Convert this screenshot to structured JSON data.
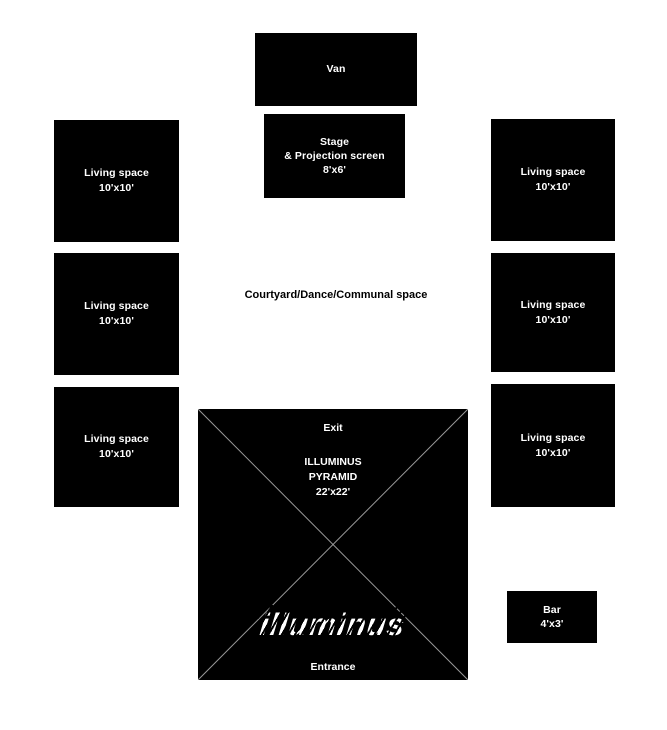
{
  "colors": {
    "background": "#ffffff",
    "box_fill": "#000000",
    "box_text": "#ffffff",
    "diagonal_line": "#9a9a9a",
    "courtyard_text": "#000000"
  },
  "van": {
    "label": "Van"
  },
  "stage": {
    "line1": "Stage",
    "line2": "& Projection screen",
    "line3": "8'x6'"
  },
  "living_spaces": [
    {
      "id": "left-1",
      "line1": "Living space",
      "line2": "10'x10'"
    },
    {
      "id": "left-2",
      "line1": "Living space",
      "line2": "10'x10'"
    },
    {
      "id": "left-3",
      "line1": "Living space",
      "line2": "10'x10'"
    },
    {
      "id": "right-1",
      "line1": "Living space",
      "line2": "10'x10'"
    },
    {
      "id": "right-2",
      "line1": "Living space",
      "line2": "10'x10'"
    },
    {
      "id": "right-3",
      "line1": "Living space",
      "line2": "10'x10'"
    }
  ],
  "courtyard": {
    "label": "Courtyard/Dance/Communal space"
  },
  "pyramid": {
    "exit_label": "Exit",
    "title_line1": "ILLUMINUS",
    "title_line2": "PYRAMID",
    "title_line3": "22'x22'",
    "logo_text": "illuminus",
    "entrance_label": "Entrance"
  },
  "bar": {
    "line1": "Bar",
    "line2": "4'x3'"
  }
}
